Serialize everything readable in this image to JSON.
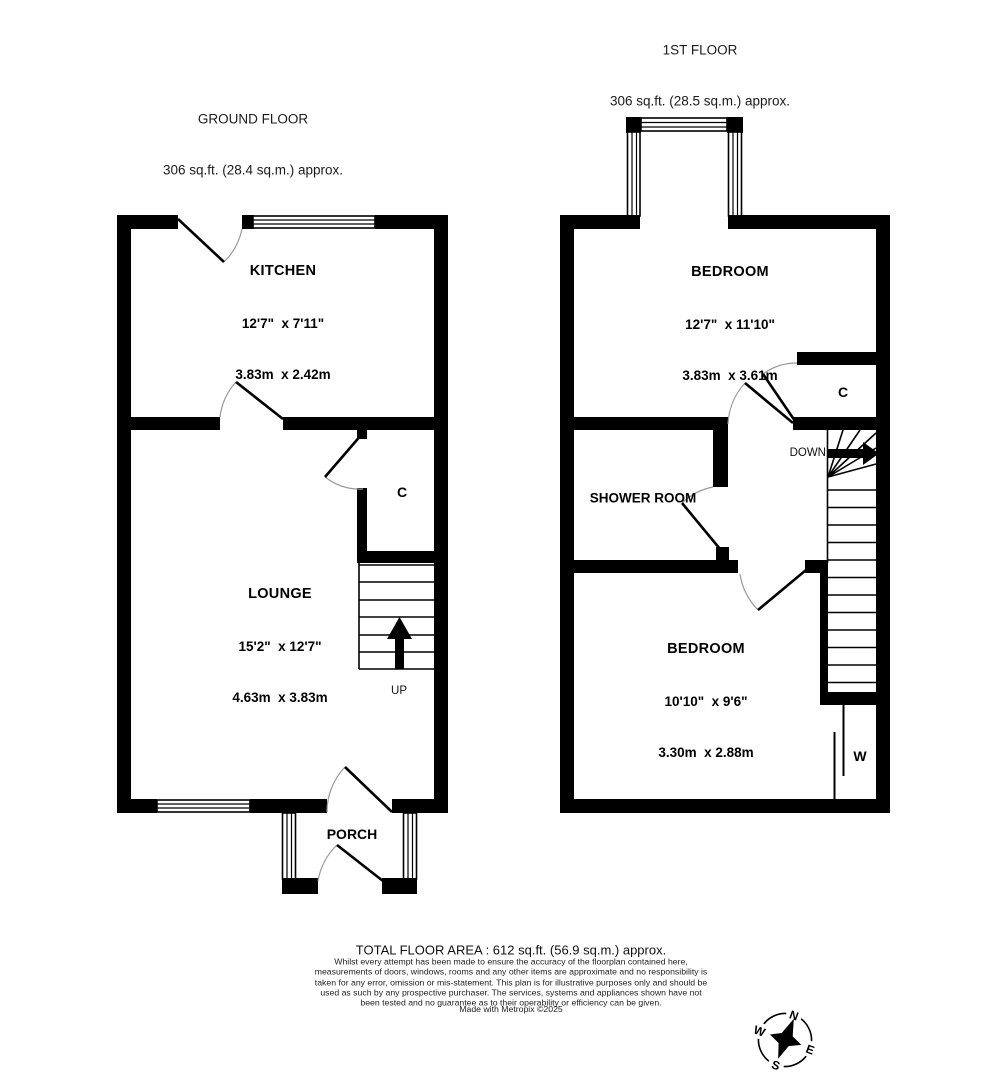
{
  "ground_floor": {
    "title": "GROUND FLOOR",
    "area": "306 sq.ft. (28.4 sq.m.) approx.",
    "kitchen_name": "KITCHEN",
    "kitchen_imperial": "12'7\"  x 7'11\"",
    "kitchen_metric": "3.83m  x 2.42m",
    "lounge_name": "LOUNGE",
    "lounge_imperial": "15'2\"  x 12'7\"",
    "lounge_metric": "4.63m  x 3.83m",
    "porch_name": "PORCH",
    "cupboard_label": "C",
    "stairs_label": "UP"
  },
  "first_floor": {
    "title": "1ST FLOOR",
    "area": "306 sq.ft. (28.5 sq.m.) approx.",
    "bedroom1_name": "BEDROOM",
    "bedroom1_imperial": "12'7\"  x 11'10\"",
    "bedroom1_metric": "3.83m  x 3.61m",
    "bedroom2_name": "BEDROOM",
    "bedroom2_imperial": "10'10\"  x 9'6\"",
    "bedroom2_metric": "3.30m  x 2.88m",
    "shower_room_name": "SHOWER ROOM",
    "cupboard_label": "C",
    "wardrobe_label": "W",
    "stairs_label": "DOWN"
  },
  "footer": {
    "total_area": "TOTAL FLOOR AREA : 612 sq.ft. (56.9 sq.m.) approx.",
    "disclaimer": "Whilst every attempt has been made to ensure the accuracy of the floorplan contained here, measurements of doors, windows, rooms and any other items are approximate and no responsibility is taken for any error, omission or mis-statement. This plan is for illustrative purposes only and should be used as such by any prospective purchaser. The services, systems and appliances shown have not been tested and no guarantee as to their operability or efficiency can be given.",
    "credit": "Made with Metropix ©2025"
  },
  "compass": {
    "n": "N",
    "e": "E",
    "s": "S",
    "w": "W"
  },
  "colors": {
    "wall": "#000000",
    "background": "#ffffff",
    "door_arc": "#999999"
  }
}
